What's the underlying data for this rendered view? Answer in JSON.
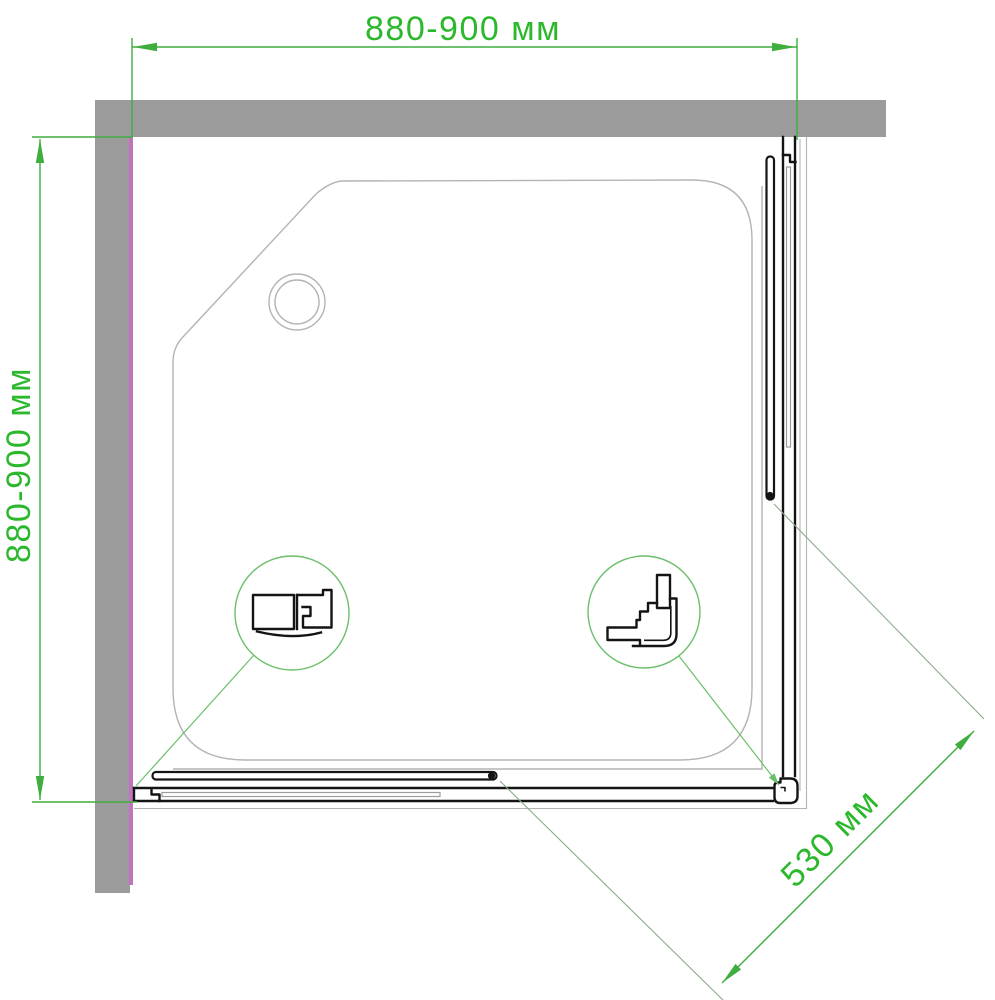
{
  "dimensions": {
    "top": {
      "label": "880-900 мм"
    },
    "left": {
      "label": "880-900 мм"
    },
    "diagonal": {
      "label": "530 мм"
    }
  },
  "colors": {
    "dimension_text_green": "#2cb82c",
    "dimension_line_green": "#3fae3f",
    "detail_circle_green": "#6abf69",
    "extension_line_green": "#8aab8a",
    "wall_gray": "#9b9b9b",
    "wall_accent_magenta": "#c472c0",
    "tray_outline_gray": "#b4b4b4",
    "glass_gray": "#9c9c9c",
    "profile_black": "#141414",
    "background": "#ffffff"
  }
}
